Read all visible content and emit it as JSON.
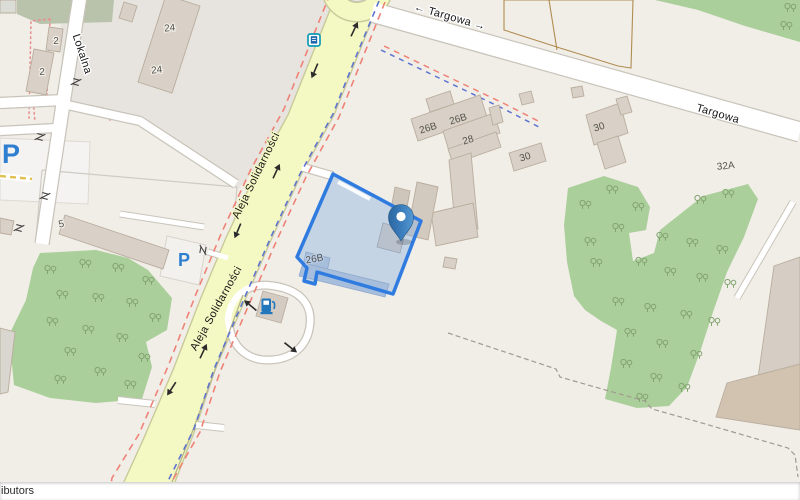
{
  "map": {
    "streets": {
      "targowa_with_arrows": "← Targowa →",
      "targowa": "Targowa",
      "aleja_solidarnosci": "Aleja Solidarności",
      "lokalna": "Lokalna"
    },
    "addresses": [
      "2",
      "2",
      "24",
      "24",
      "5",
      "26B",
      "26B",
      "26B",
      "28",
      "30",
      "30",
      "32A"
    ],
    "icons": {
      "parking_letter": "P",
      "bus_stop": "bus-stop-icon",
      "fuel": "fuel-station-icon",
      "marker": "location-pin-icon",
      "gate": "gate-icon",
      "tree": "deciduous-tree-icon"
    },
    "colors": {
      "land": "#f1eee8",
      "landuse_gray": "#e7e4df",
      "green": "#abcf9b",
      "road_major": "#f4f8c2",
      "road_minor": "#ffffff",
      "building": "#d9d0c7",
      "selection_stroke": "#2f7be0",
      "selection_fill": "#8fb4e3",
      "marker_blue": "#3d7fbe",
      "parking_blue": "#2e7fd0",
      "route_red": "#ef8276",
      "route_blue": "#5f74cf"
    },
    "attribution": "ibutors"
  }
}
